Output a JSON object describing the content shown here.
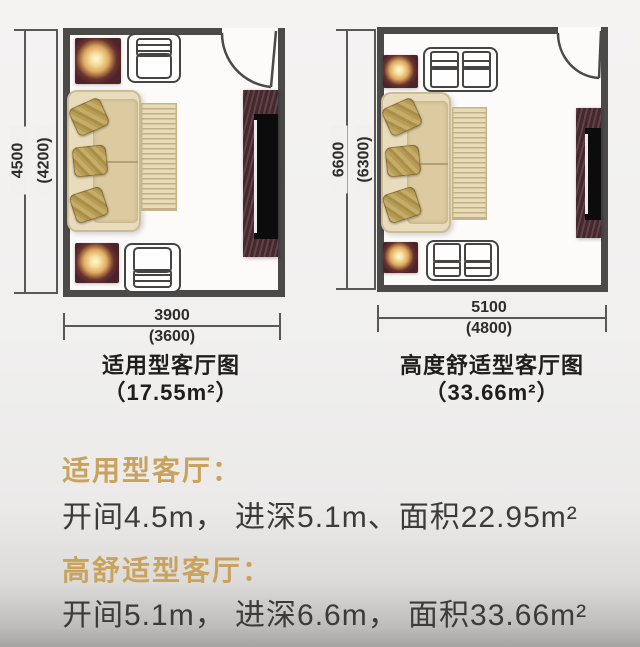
{
  "plans": [
    {
      "name": "standard-living-room-plan",
      "caption": {
        "line1": "适用型客厅图",
        "line2": "（17.55m²）"
      },
      "dims": {
        "width_main": "3900",
        "width_inner": "(3600)",
        "depth_main": "4500",
        "depth_inner": "(4200)"
      },
      "furniture": [
        "floor-lamp",
        "armchair",
        "three-seat-sofa",
        "throw-pillows",
        "area-rug",
        "tv-cabinet",
        "tv",
        "door"
      ]
    },
    {
      "name": "high-comfort-living-room-plan",
      "caption": {
        "line1": "高度舒适型客厅图",
        "line2": "（33.66m²）"
      },
      "dims": {
        "width_main": "5100",
        "width_inner": "(4800)",
        "depth_main": "6600",
        "depth_inner": "(6300)"
      },
      "furniture": [
        "floor-lamp",
        "loveseat",
        "three-seat-sofa",
        "throw-pillows",
        "area-rug",
        "tv-cabinet",
        "tv",
        "door"
      ]
    }
  ],
  "specs": [
    {
      "title": "适用型客厅：",
      "detail": "开间4.5m， 进深5.1m、面积22.95m²"
    },
    {
      "title": "高舒适型客厅：",
      "detail": "开间5.1m， 进深6.6m， 面积33.66m²"
    }
  ],
  "colors": {
    "wall": "#4c4a49",
    "accent_gold": "#c9a35e",
    "body_text": "#3b3b3b",
    "lamp_table": "#4a232b",
    "sofa_beige": "#e9dcbc",
    "tv_wood": "#55323a"
  }
}
